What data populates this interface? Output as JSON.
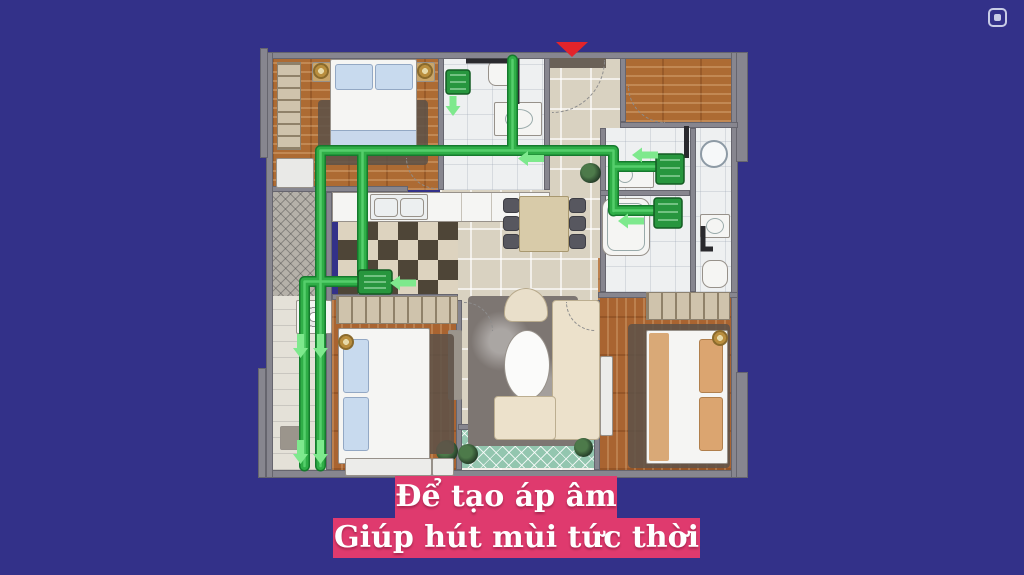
{
  "window": {
    "background_color": "#333189",
    "controls": {
      "pip_icon": "picture-in-picture-icon"
    }
  },
  "floor_plan": {
    "type": "apartment-ventilation-diagram",
    "entrance_marker_color": "#e3242b",
    "duct_color": "#2fae47",
    "duct_border_color": "#157a2d",
    "airflow_arrow_color": "#7ee98d"
  },
  "caption": {
    "line1": "Để tạo áp âm",
    "line2": "Giúp hút mùi tức thời",
    "background_color": "#df3a6e",
    "text_color": "#ffffff"
  }
}
